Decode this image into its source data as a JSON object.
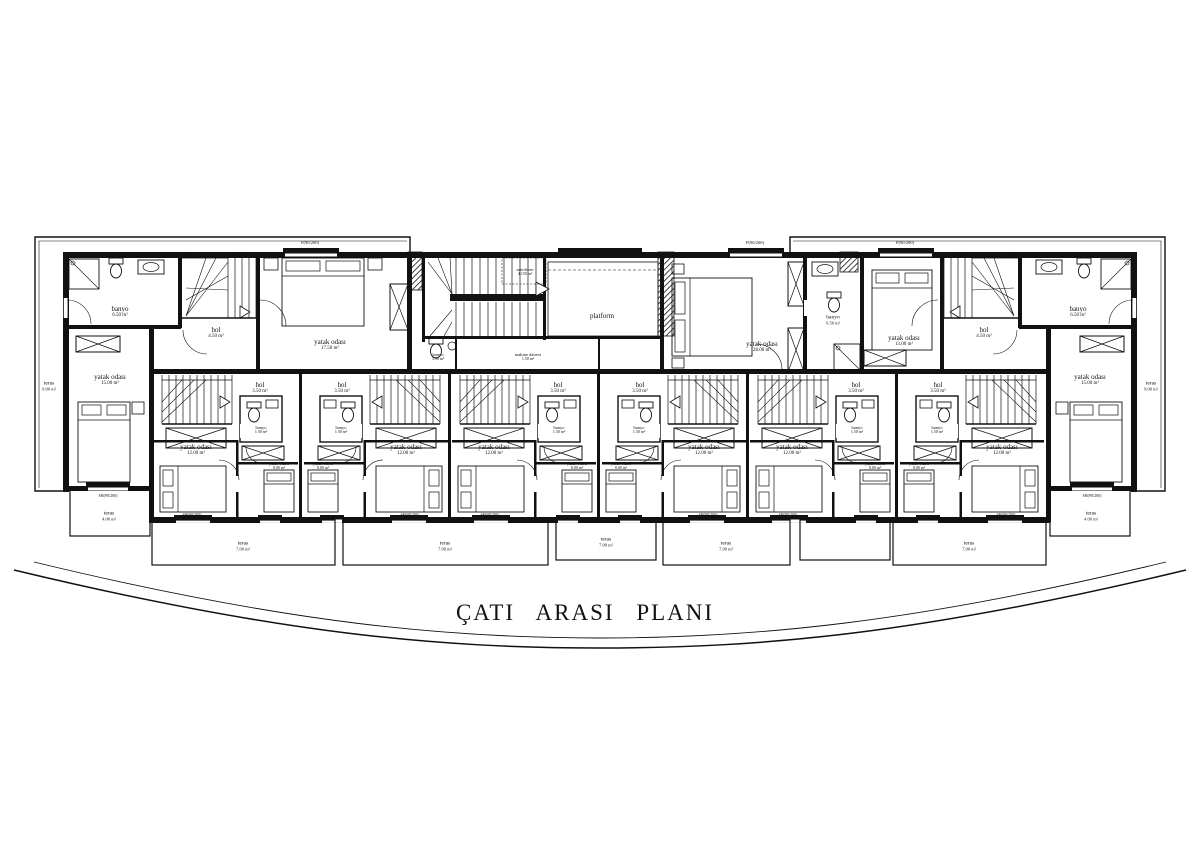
{
  "title": "ÇATI ARASI PLANI",
  "window_label": "P(90/200)",
  "door_label": "SH(90/200)",
  "left_unit": {
    "teras": {
      "name": "teras",
      "area": "9.00 m²"
    },
    "banyo": {
      "name": "banyo",
      "area": "6.50 m²"
    },
    "hol": {
      "name": "hol",
      "area": "4.50 m²"
    },
    "bedroom_inner": {
      "name": "yatak odası",
      "area": "17.50 m²"
    },
    "bedroom_outer": {
      "name": "yatak odası",
      "area": "15.00 m²"
    }
  },
  "center": {
    "merdiven": {
      "name": "merdiven",
      "area": "4.150 m²"
    },
    "platform": {
      "name": "platform"
    },
    "makine": {
      "name": "makine dairesi",
      "area": "1.50 m²"
    },
    "banyo": {
      "name": "banyo",
      "area": "3.50 m²"
    },
    "bedroom": {
      "name": "yatak odası",
      "area": "28.00 m²"
    },
    "banyo2": {
      "name": "banyo",
      "area": "6.50 m²"
    }
  },
  "right_unit": {
    "bedroom_inner": {
      "name": "yatak odası",
      "area": "13.00 m²"
    },
    "hol": {
      "name": "hol",
      "area": "4.50 m²"
    },
    "banyo": {
      "name": "banyo",
      "area": "6.50 m²"
    },
    "bedroom_outer": {
      "name": "yatak odası",
      "area": "15.00 m²"
    },
    "teras": {
      "name": "teras",
      "area": "9.00 m²"
    }
  },
  "modules": [
    {
      "hol_name": "hol",
      "hol_area": "3.50 m²",
      "banyo_name": "banyo",
      "banyo_area": "1.50 m²",
      "bed_large_name": "yatak odası",
      "bed_large_area": "12.00 m²",
      "bed_small_name": "yatak odası",
      "bed_small_area": "8.00 m²"
    },
    {
      "hol_name": "hol",
      "hol_area": "3.50 m²",
      "banyo_name": "banyo",
      "banyo_area": "1.50 m²",
      "bed_large_name": "yatak odası",
      "bed_large_area": "12.00 m²",
      "bed_small_name": "yatak odası",
      "bed_small_area": "8.00 m²"
    },
    {
      "hol_name": "hol",
      "hol_area": "3.50 m²",
      "banyo_name": "banyo",
      "banyo_area": "1.50 m²",
      "bed_large_name": "yatak odası",
      "bed_large_area": "12.00 m²",
      "bed_small_name": "yatak odası",
      "bed_small_area": "8.00 m²"
    },
    {
      "hol_name": "hol",
      "hol_area": "3.50 m²",
      "banyo_name": "banyo",
      "banyo_area": "1.50 m²",
      "bed_large_name": "yatak odası",
      "bed_large_area": "12.00 m²",
      "bed_small_name": "yatak odası",
      "bed_small_area": "8.00 m²"
    },
    {
      "hol_name": "hol",
      "hol_area": "3.50 m²",
      "banyo_name": "banyo",
      "banyo_area": "1.50 m²",
      "bed_large_name": "yatak odası",
      "bed_large_area": "12.00 m²",
      "bed_small_name": "yatak odası",
      "bed_small_area": "8.00 m²"
    },
    {
      "hol_name": "hol",
      "hol_area": "3.50 m²",
      "banyo_name": "banyo",
      "banyo_area": "1.50 m²",
      "bed_large_name": "yatak odası",
      "bed_large_area": "12.00 m²",
      "bed_small_name": "yatak odası",
      "bed_small_area": "8.00 m²"
    }
  ],
  "terraces": {
    "side_left": {
      "name": "teras",
      "area": "4.00 m²"
    },
    "side_right": {
      "name": "teras",
      "area": "4.00 m²"
    },
    "front": [
      {
        "name": "teras",
        "area": "7.00 m²"
      },
      {
        "name": "teras",
        "area": "7.00 m²"
      },
      {
        "name": "teras",
        "area": "7.00 m²"
      },
      {
        "name": "teras",
        "area": "7.00 m²"
      },
      {
        "name": "teras",
        "area": "7.00 m²"
      }
    ]
  },
  "colors": {
    "line": "#111111",
    "bg": "#ffffff"
  }
}
